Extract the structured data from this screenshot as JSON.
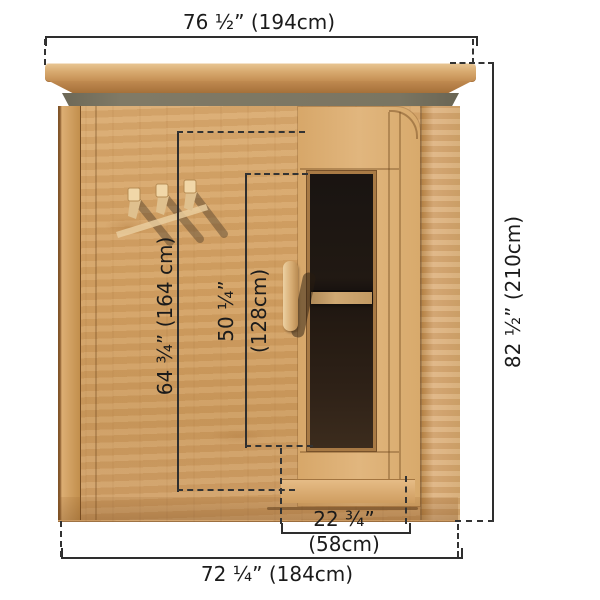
{
  "diagram": {
    "subject": "cedar-sauna-front-elevation",
    "labels": {
      "roof_width": "76 ½” (194cm)",
      "overall_height": "82 ½” (210cm)",
      "cabin_width": "72 ¼” (184cm)",
      "panel_height": "64 ¾” (164 cm)",
      "glass_height_in": "50 ¼”",
      "glass_height_cm": "(128cm)",
      "door_width_in": "22 ¾”",
      "door_width_cm": "(58cm)"
    },
    "colors": {
      "dimension_line": "#2e2e2e",
      "text": "#1b1b1b",
      "wood_light": "#e3bc8a",
      "wood_mid": "#d2a167",
      "wood_dark": "#a87238",
      "roof_shadow": "#75705e",
      "glass": "#1e1712",
      "background": "#ffffff"
    }
  }
}
